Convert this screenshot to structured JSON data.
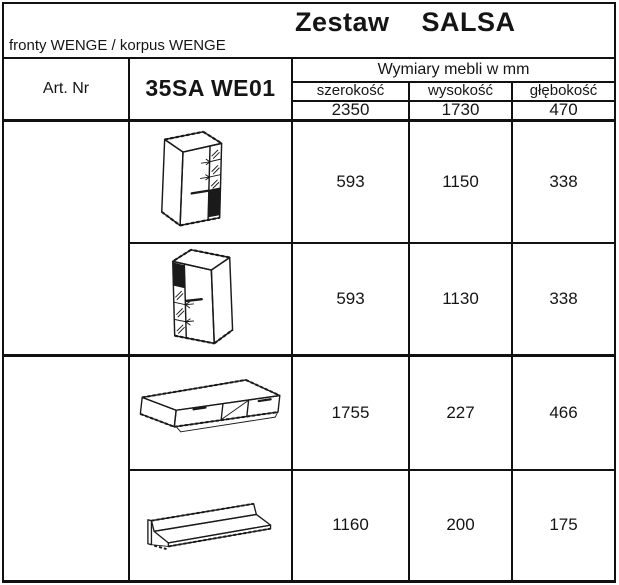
{
  "title": "Zestaw    SALSA",
  "subtitle": "fronty WENGE / korpus WENGE",
  "table": {
    "art_label": "Art. Nr",
    "product_code": "35SA WE01",
    "dims_header": "Wymiary mebli w mm",
    "columns": {
      "width": "szerokość",
      "height": "wysokość",
      "depth": "głębokość"
    },
    "totals": {
      "width": "2350",
      "height": "1730",
      "depth": "470"
    },
    "rows": [
      {
        "item": "display cabinet, glass column right",
        "w": "593",
        "h": "1150",
        "d": "338"
      },
      {
        "item": "display cabinet, glass column left",
        "w": "593",
        "h": "1130",
        "d": "338"
      },
      {
        "item": "tv stand with two drawers",
        "w": "1755",
        "h": "227",
        "d": "466"
      },
      {
        "item": "wall shelf",
        "w": "1160",
        "h": "200",
        "d": "175"
      }
    ]
  },
  "colors": {
    "ink": "#111111",
    "paper": "#ffffff"
  }
}
